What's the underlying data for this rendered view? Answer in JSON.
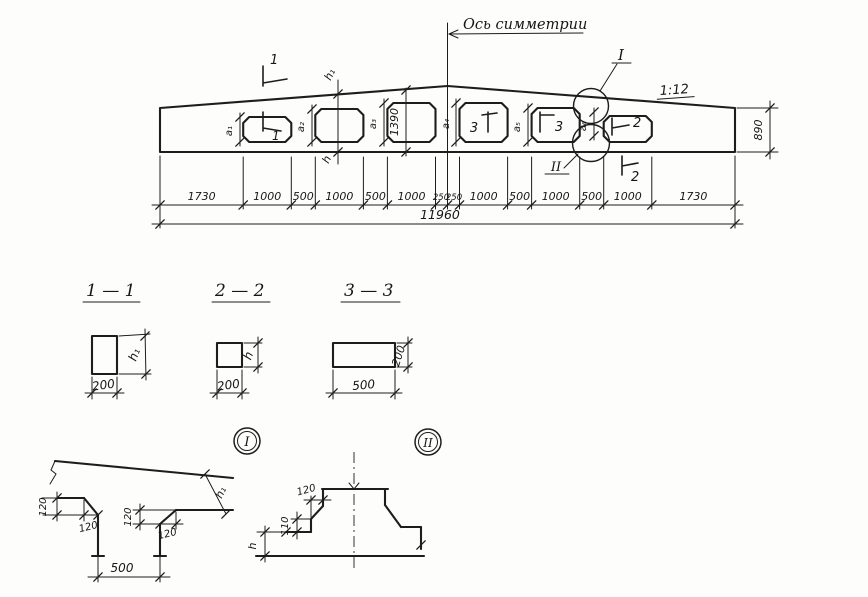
{
  "drawing": {
    "axis_label": "Ось симметрии",
    "slope_label": "1:12",
    "detail_ref_top": "I",
    "detail_ref_bottom": "II",
    "cut_top_label": "1",
    "cut_o1_label": "1",
    "cut_o4_label": "3",
    "cut_o5_label": "3",
    "cut_o6_label": "2",
    "cut_bottom_label": "2",
    "height_right": "890",
    "height_center": "1390",
    "h1_label": "h₁",
    "h_label": "h",
    "opening_height_labels": [
      "а₁",
      "а₂",
      "а₃",
      "а₄",
      "а₅",
      "а₆"
    ],
    "dims_segments": [
      "1730",
      "1000",
      "500",
      "1000",
      "500",
      "1000",
      "250",
      "250",
      "1000",
      "500",
      "1000",
      "500",
      "1000",
      "1730"
    ],
    "dim_total": "11960"
  },
  "sections": {
    "s1": {
      "title": "1 — 1",
      "width_dim": "200",
      "height_dim": "h₁"
    },
    "s2": {
      "title": "2 — 2",
      "width_dim": "200",
      "height_dim": "h"
    },
    "s3": {
      "title": "3 — 3",
      "width_dim": "500",
      "height_dim": "200"
    }
  },
  "detail_one": {
    "ref": "I",
    "flange_dim": "120",
    "chamfer_w_left": "120",
    "web_dim": "120",
    "chamfer_w_right": "120",
    "depth_dim": "h₁",
    "width_dim": "500"
  },
  "detail_two": {
    "ref": "II",
    "top_dim": "120",
    "side_dim": "110",
    "height_dim": "h"
  }
}
